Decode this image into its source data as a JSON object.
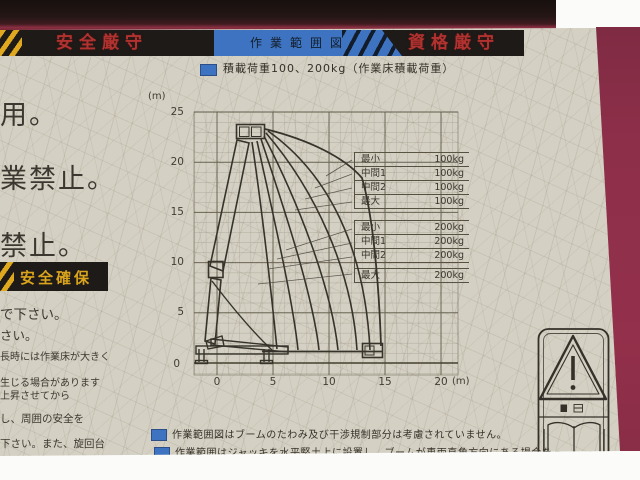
{
  "colors": {
    "label_bg": "#d4d0c3",
    "banner_bg": "#1d1a17",
    "banner_red": "#b23230",
    "band_blue": "#3d73c0",
    "hazard_yellow": "#dfa81e",
    "machine_body": "#8e2f4a",
    "ink": "#3a362e"
  },
  "banner": {
    "left": "安全厳守",
    "center": "作業範囲図",
    "right": "資格厳守"
  },
  "legend_title": {
    "text": "積載荷重100、200kg（作業床積載荷重）"
  },
  "chart": {
    "unit_y": "(m)",
    "unit_x": "(m)",
    "y_ticks": [
      "25",
      "20",
      "15",
      "10",
      "5",
      "0"
    ],
    "x_ticks": [
      "0",
      "5",
      "10",
      "15",
      "20"
    ],
    "x_range_m": [
      0,
      20
    ],
    "y_range_m": [
      0,
      25
    ],
    "grid_step_m": 1,
    "load_tables": [
      {
        "rows": [
          {
            "label": "最小",
            "value": "100kg"
          },
          {
            "label": "中間1",
            "value": "100kg"
          },
          {
            "label": "中間2",
            "value": "100kg"
          },
          {
            "label": "最大",
            "value": "100kg"
          }
        ]
      },
      {
        "rows": [
          {
            "label": "最小",
            "value": "200kg"
          },
          {
            "label": "中間1",
            "value": "200kg"
          },
          {
            "label": "中間2",
            "value": "200kg"
          },
          {
            "label": "最大",
            "value": "200kg"
          }
        ]
      }
    ]
  },
  "left_panel": {
    "fragments": [
      "用。",
      "業禁止。",
      "禁止。"
    ],
    "banner": "安全確保",
    "lines": [
      "で下さい。",
      "さい。",
      "長時には作業床が大きく",
      "生じる場合があります",
      "上昇させてから",
      "し、周囲の安全を",
      "下さい。また、旋回台"
    ]
  },
  "notes": [
    {
      "text": "作業範囲図はブームのたわみ及び干渉規制部分は考慮されていません。"
    },
    {
      "text": "作業範囲はジャッキを水平堅土上に設置し、ブームが車両直角方向にある場合を"
    }
  ],
  "pictogram": {
    "name": "warning-read-manual"
  }
}
